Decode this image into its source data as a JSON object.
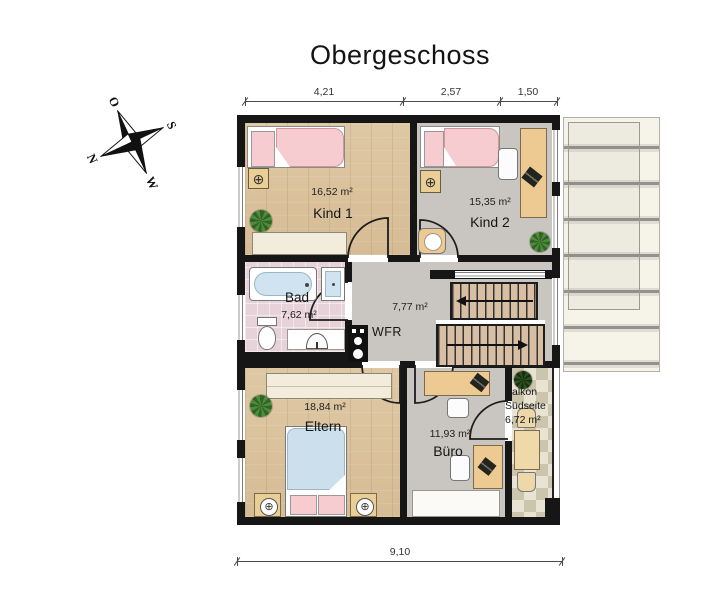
{
  "title": "Obergeschoss",
  "compass": {
    "north": "N",
    "east": "O",
    "south": "S",
    "west": "W"
  },
  "dimensions": {
    "top_left": "4,21",
    "top_middle": "2,57",
    "top_right": "1,50",
    "bottom_total": "9,10"
  },
  "rooms": {
    "kind1": {
      "name": "Kind 1",
      "area": "16,52 m²"
    },
    "kind2": {
      "name": "Kind 2",
      "area": "15,35 m²"
    },
    "bad": {
      "name": "Bad",
      "area": "7,62 m²"
    },
    "hallway": {
      "area": "7,77 m²",
      "closet_label": "WFR"
    },
    "eltern": {
      "name": "Eltern",
      "area": "18,84 m²"
    },
    "buero": {
      "name": "Büro",
      "area": "11,93 m²"
    },
    "balkon": {
      "name": "Balkon",
      "orientation": "Südseite",
      "area": "6,72 m²"
    }
  },
  "colors": {
    "wall": "#161616",
    "wood_floor": "#dcc5a0",
    "gray_floor": "#c9c6c1",
    "bath_floor": "#e6d2d8",
    "balcony_tile": "#e9e3d3",
    "bed_pink": "#f6ccd0",
    "duvet_blue": "#cbdfec",
    "furniture_tan": "#ecca92"
  }
}
